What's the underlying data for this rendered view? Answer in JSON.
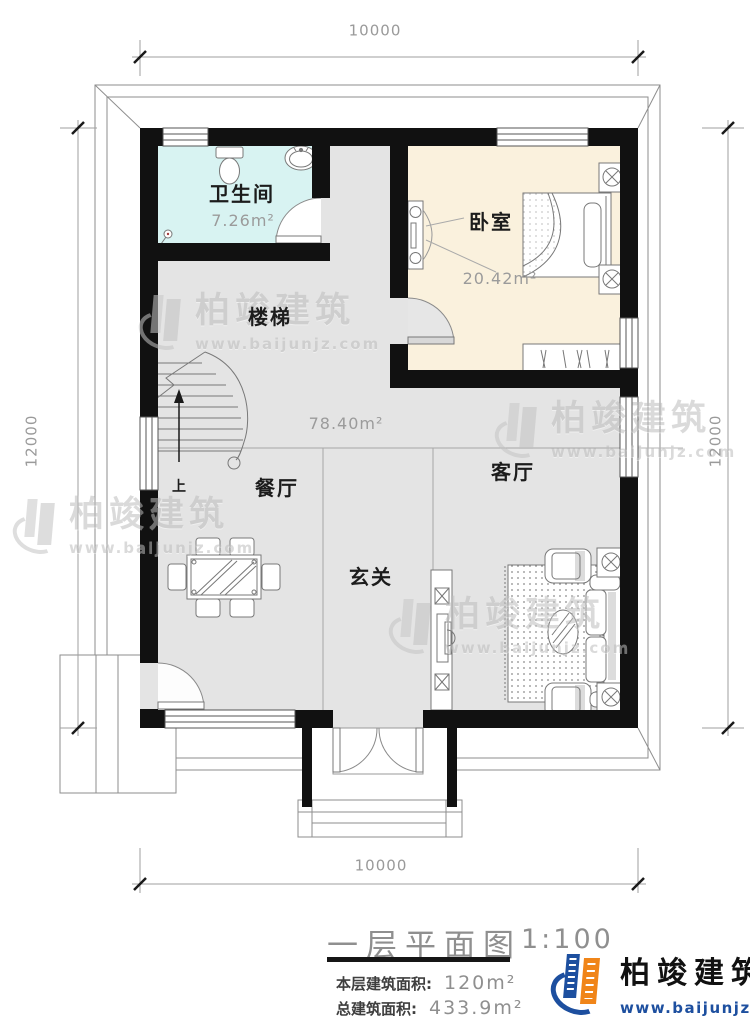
{
  "dimensions": {
    "top": "10000",
    "bottom": "10000",
    "left": "12000",
    "right": "12000"
  },
  "rooms": {
    "bathroom": {
      "name": "卫生间",
      "area": "7.26m²",
      "fill": "#d8f3f2"
    },
    "bedroom": {
      "name": "卧室",
      "area": "20.42m²",
      "fill": "#faf1dd"
    },
    "stairs": {
      "name": "楼梯",
      "up": "上"
    },
    "open_area": {
      "area": "78.40m²"
    },
    "dining": {
      "name": "餐厅"
    },
    "foyer": {
      "name": "玄关"
    },
    "living": {
      "name": "客厅"
    }
  },
  "floor_fill": "#e4e4e4",
  "wall_color": "#111111",
  "title_block": {
    "title": "一层平面图",
    "scale": "1:100",
    "floor_area_label": "本层建筑面积:",
    "floor_area_value": "120m²",
    "total_area_label": "总建筑面积:",
    "total_area_value": "433.9m²"
  },
  "brand": {
    "name": "柏竣建筑",
    "website": "www.baijunjz.com",
    "orange": "#f08519",
    "blue": "#1d4f9f"
  },
  "watermark": {
    "name": "柏竣建筑",
    "website": "www.baijunjz.com"
  }
}
